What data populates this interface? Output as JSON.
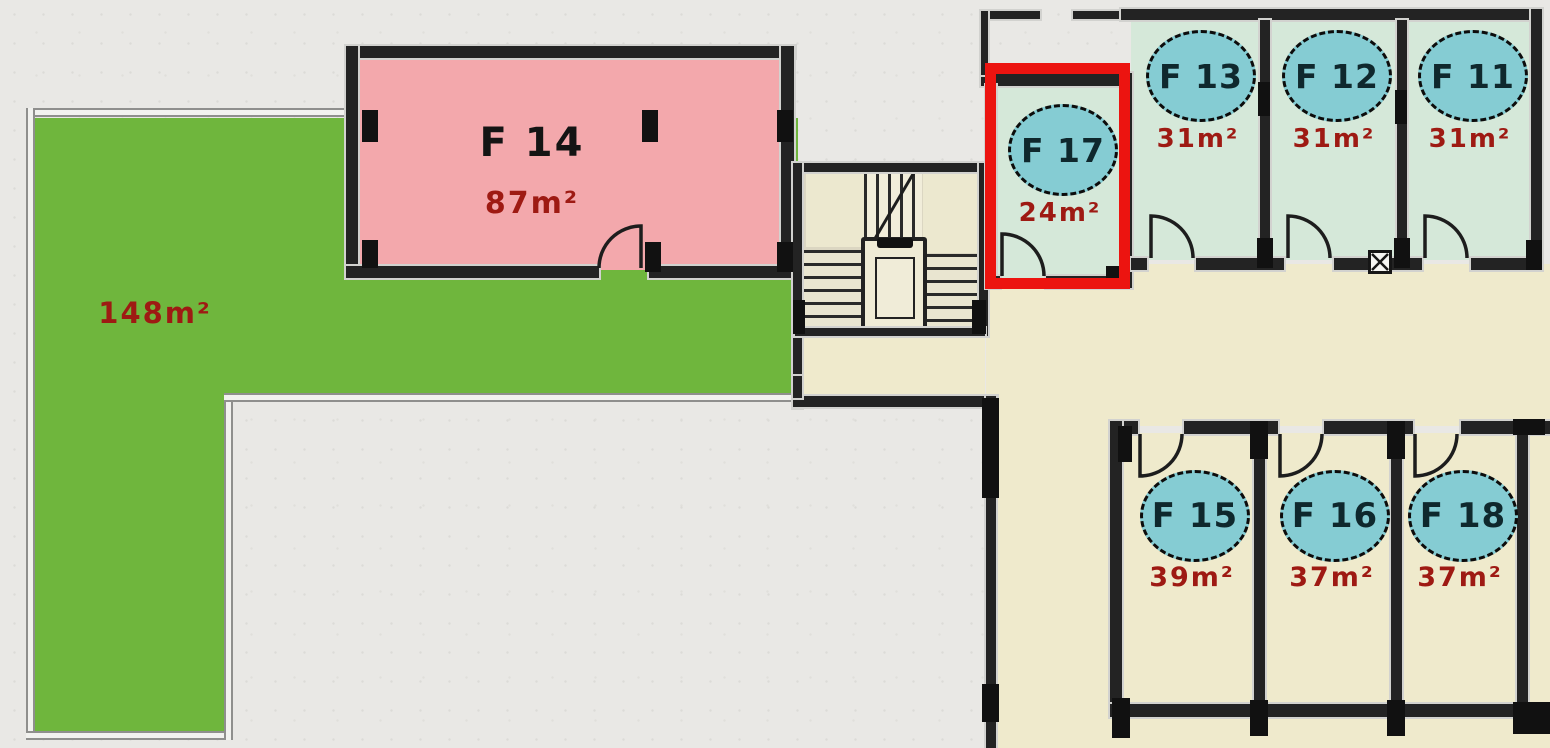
{
  "rooms": {
    "f14": {
      "label": "F 14",
      "area": "87m²"
    },
    "f17": {
      "label": "F 17",
      "area": "24m²"
    },
    "f13": {
      "label": "F 13",
      "area": "31m²"
    },
    "f12": {
      "label": "F 12",
      "area": "31m²"
    },
    "f11": {
      "label": "F 11",
      "area": "31m²"
    },
    "f15": {
      "label": "F 15",
      "area": "39m²"
    },
    "f16": {
      "label": "F 16",
      "area": "37m²"
    },
    "f18": {
      "label": "F 18",
      "area": "37m²"
    }
  },
  "terrace": {
    "area": "148m²"
  },
  "highlight": {
    "room_label": "F 17"
  },
  "colors": {
    "terrace_green": "#6fb63d",
    "room_pink": "#f3a8ac",
    "room_mint": "#d5e8d9",
    "room_beige": "#efeacc",
    "badge_teal": "#85ccd3",
    "area_text_red": "#9e1a13",
    "highlight_red": "#ec1410",
    "wall_dark": "#232323"
  }
}
